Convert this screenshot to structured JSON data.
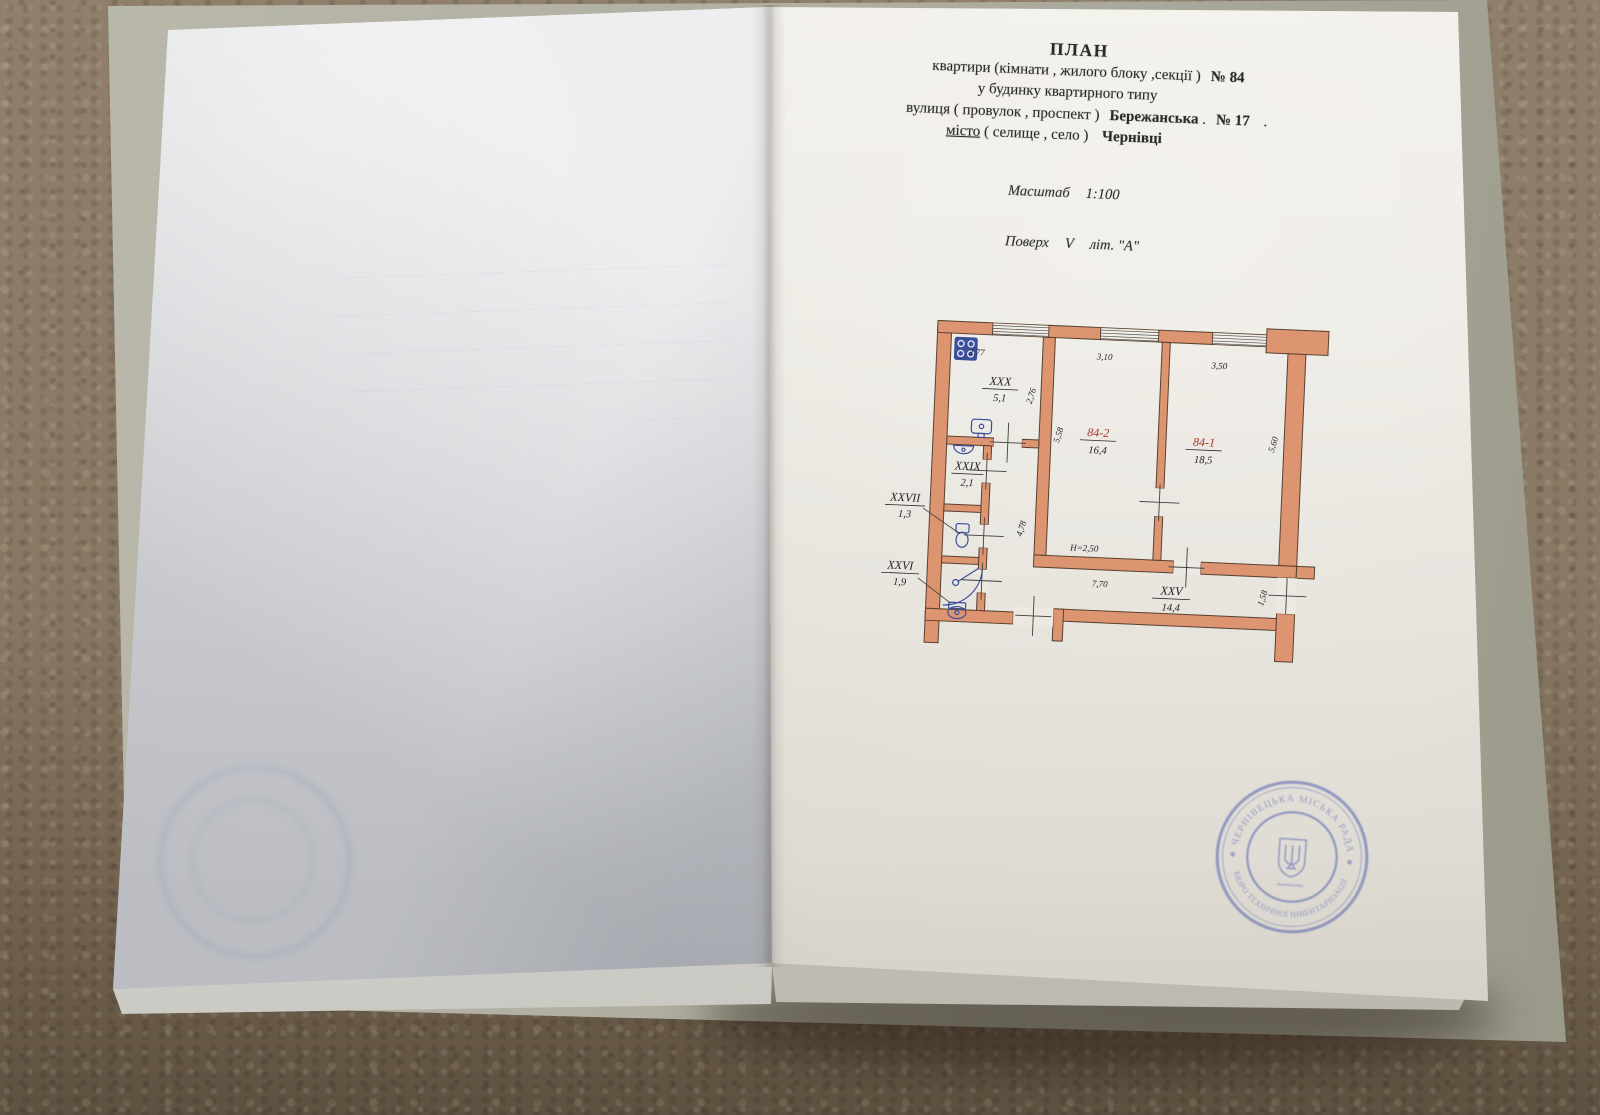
{
  "header": {
    "title": "ПЛАН",
    "line2_pre": "квартири (кімнати , жилого блоку ,секції )",
    "line2_no": "№ 84",
    "line3": "у будинку квартирного типу",
    "line4_pre": "вулиця ( провулок , проспект )",
    "line4_street": "Бережанська",
    "dot": ".",
    "line4_no": "№ 17",
    "line5_label": "місто",
    "line5_paren": "( селище , село )",
    "line5_city": "Чернівці",
    "scale_label": "Масштаб",
    "scale_value": "1:100",
    "floor_label": "Поверх",
    "floor_value": "V",
    "floor_lit": "літ. \"А\""
  },
  "floor_plan": {
    "wall_color": "#dd9470",
    "fixture_color": "#3b4f9b",
    "rooms": [
      {
        "name": "XXX",
        "area": "5,1"
      },
      {
        "name": "XXIX",
        "area": "2,1"
      },
      {
        "name": "XXVII",
        "area": "1,3"
      },
      {
        "name": "XXVI",
        "area": "1,9"
      },
      {
        "name": "XXV",
        "area": "14,4"
      },
      {
        "name": "84-2",
        "area": "16,4"
      },
      {
        "name": "84-1",
        "area": "18,5"
      }
    ],
    "dims": {
      "kitchen_w": "2,77",
      "room2_w": "3,10",
      "room1_w": "3,50",
      "kitchen_h": "2,76",
      "room2_h": "5,58",
      "room1_h": "5,60",
      "hall_h": "4,78",
      "corridor_w": "7,70",
      "exit_w": "1,58"
    },
    "ceiling_height": "Н=2,50"
  },
  "stamp": {
    "color": "#5a6ab0",
    "ring_text_top": "ЧЕРНІВЕЦЬКА МІСЬКА РАДА",
    "ring_text_bottom": "БЮРО ТЕХНІЧНОЇ ІНВЕНТАРИЗАЦІЇ",
    "separator": "✱",
    "emblem": "trident"
  }
}
